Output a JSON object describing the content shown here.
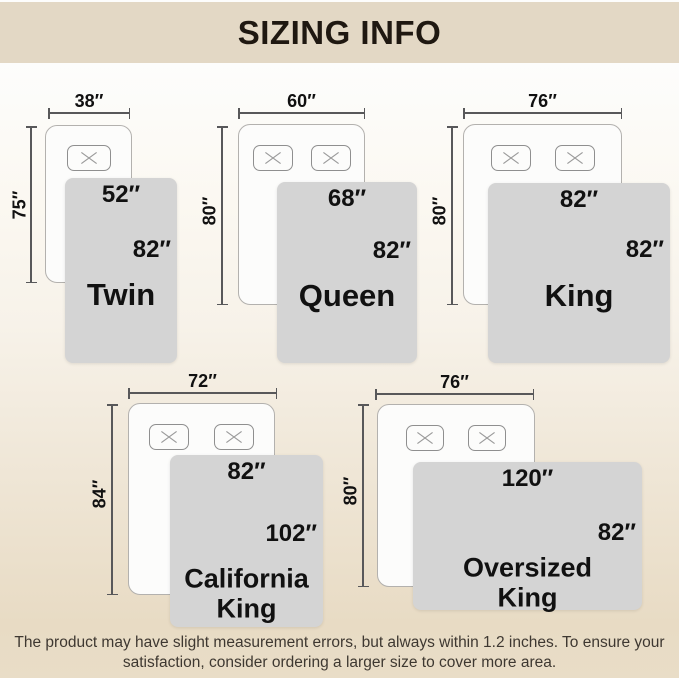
{
  "header": {
    "title": "SIZING INFO"
  },
  "sizes": [
    {
      "name": "Twin",
      "mattress_width": "38″",
      "mattress_length": "75″",
      "blanket_width": "52″",
      "blanket_length": "82″",
      "pillow_count": 1
    },
    {
      "name": "Queen",
      "mattress_width": "60″",
      "mattress_length": "80″",
      "blanket_width": "68″",
      "blanket_length": "82″",
      "pillow_count": 2
    },
    {
      "name": "King",
      "mattress_width": "76″",
      "mattress_length": "80″",
      "blanket_width": "82″",
      "blanket_length": "82″",
      "pillow_count": 2
    },
    {
      "name": "California",
      "name_line2": "King",
      "mattress_width": "72″",
      "mattress_length": "84″",
      "blanket_width": "82″",
      "blanket_length": "102″",
      "pillow_count": 2
    },
    {
      "name": "Oversized",
      "name_line2": "King",
      "mattress_width": "76″",
      "mattress_length": "80″",
      "blanket_width": "120″",
      "blanket_length": "82″",
      "pillow_count": 2
    }
  ],
  "footer": {
    "line1": "The product may have slight measurement errors, but always within 1.2 inches. To ensure your",
    "line2": "satisfaction, consider ordering a larger size to cover more area."
  },
  "colors": {
    "header_bg": "#e3d8c5",
    "background_bottom": "#e9ddc7",
    "blanket": "#d4d4d4",
    "dimension_line": "#58585a",
    "text": "#111111"
  }
}
